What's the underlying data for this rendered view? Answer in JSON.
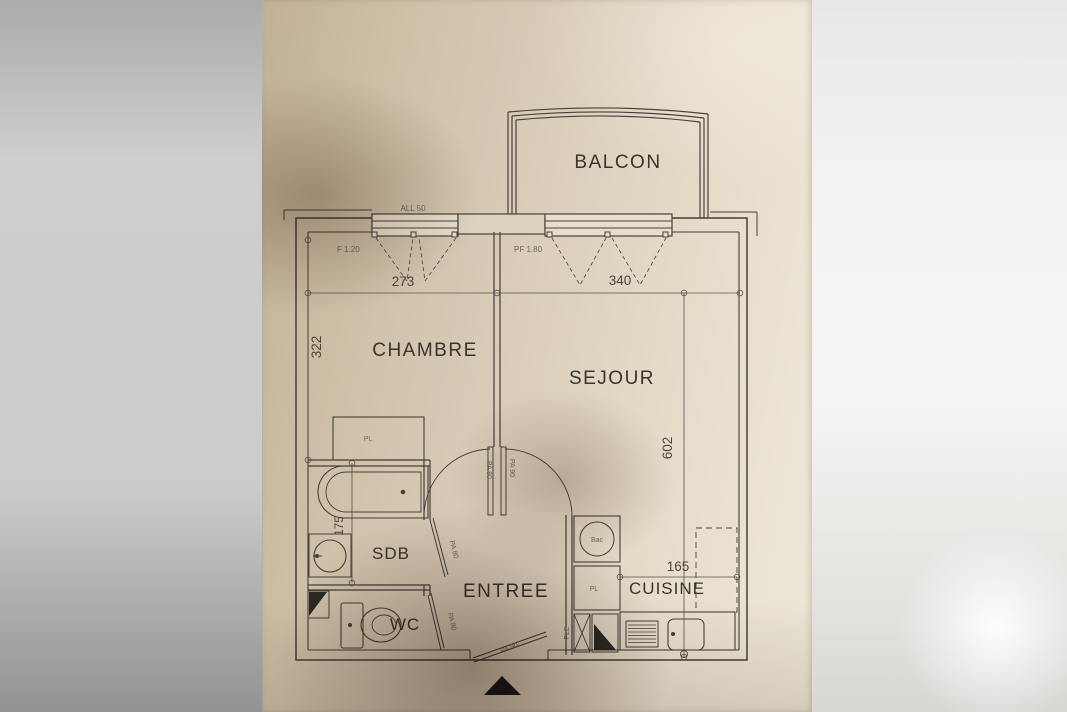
{
  "rooms": {
    "balcon": "BALCON",
    "chambre": "CHAMBRE",
    "sejour": "SEJOUR",
    "sdb": "SDB",
    "entree": "ENTREE",
    "wc": "WC",
    "cuisine": "CUISINE"
  },
  "dimensions": {
    "chambre_width_cm": "273",
    "sejour_width_cm": "340",
    "chambre_depth_cm": "322",
    "sejour_depth_cm": "602",
    "sdb_height_cm": "175",
    "cuisine_width_cm": "165"
  },
  "openings": {
    "sill_height": "ALL 50",
    "chambre_window": "F 1.20",
    "sejour_french_window": "PF 1.80",
    "chambre_door": "PA 80",
    "sejour_door": "PA 90",
    "sdb_door": "PA 80",
    "wc_door": "PA 80",
    "entry_door": "PA 90"
  },
  "fixtures": {
    "chambre_closet": "PL",
    "kitchen_sink_unit": "Bac",
    "kitchen_closet": "PL",
    "kitchen_duct": "PLE"
  },
  "colors": {
    "ink": "#46413a",
    "paper_light": "#ece4d4",
    "paper_dark": "#c3b299",
    "background_left": "#c7c9c8",
    "background_right": "#f3f2f0"
  }
}
